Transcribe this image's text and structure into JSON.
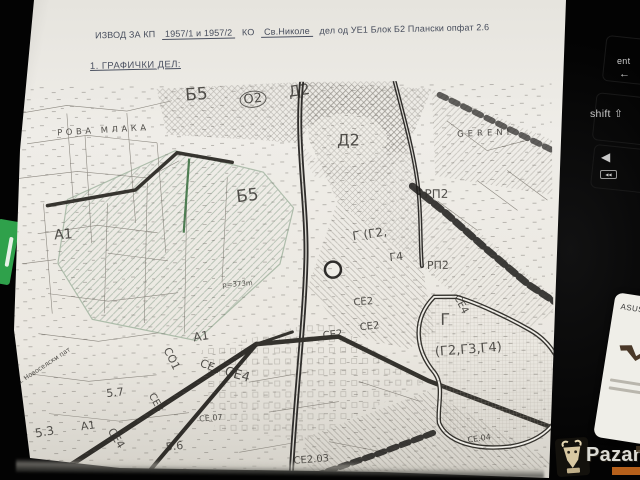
{
  "doc": {
    "header": {
      "p1": "ИЗВОД ЗА КП",
      "p2": "1957/1 и 1957/2",
      "p3": "КО",
      "p4": "Св.Николе",
      "p5": "дел од УЕ1 Блок Б2 Плански опфат 2.6"
    },
    "section_title": "1. ГРАФИЧКИ ДЕЛ:"
  },
  "map": {
    "ink_color": "#33312d",
    "green_zone_color": "#74907a",
    "labels": [
      {
        "t": "Б5",
        "x": 178,
        "y": 5,
        "s": 17,
        "r": -4
      },
      {
        "t": "О2",
        "x": 232,
        "y": 10,
        "s": 13,
        "r": -6,
        "circ": true
      },
      {
        "t": "Д2",
        "x": 281,
        "y": 3,
        "s": 15,
        "r": -8
      },
      {
        "t": "РОВА МЛАКА",
        "x": 50,
        "y": 46,
        "s": 8.5,
        "r": -3,
        "sp": 3.5
      },
      {
        "t": "GERENI",
        "x": 450,
        "y": 50,
        "s": 8.5,
        "r": -2,
        "sp": 4
      },
      {
        "t": "Д2",
        "x": 330,
        "y": 51,
        "s": 16,
        "r": 0
      },
      {
        "t": "РП2",
        "x": 417,
        "y": 107,
        "s": 12,
        "r": 0
      },
      {
        "t": "Б5",
        "x": 228,
        "y": 107,
        "s": 17,
        "r": -6
      },
      {
        "t": "А1",
        "x": 46,
        "y": 145,
        "s": 14,
        "r": -4
      },
      {
        "t": "Г (Г2,",
        "x": 344,
        "y": 149,
        "s": 12,
        "r": -8
      },
      {
        "t": "Г4",
        "x": 381,
        "y": 171,
        "s": 11,
        "r": -6
      },
      {
        "t": "РП2",
        "x": 419,
        "y": 179,
        "s": 11,
        "r": 0
      },
      {
        "t": "р=373m",
        "x": 214,
        "y": 200,
        "s": 7,
        "r": -4
      },
      {
        "t": "СЕ4",
        "x": 452,
        "y": 213,
        "s": 10,
        "r": 62
      },
      {
        "t": "СЕ2",
        "x": 345,
        "y": 217,
        "s": 10,
        "r": -4
      },
      {
        "t": "Г",
        "x": 432,
        "y": 231,
        "s": 16,
        "r": 0
      },
      {
        "t": "(Г2,Г3,Г4)",
        "x": 426,
        "y": 265,
        "s": 13,
        "r": -4
      },
      {
        "t": "СЕ2",
        "x": 314,
        "y": 250,
        "s": 10,
        "r": -6
      },
      {
        "t": "СЕ2",
        "x": 351,
        "y": 242,
        "s": 10,
        "r": -6
      },
      {
        "t": "А1",
        "x": 184,
        "y": 249,
        "s": 12,
        "r": -8
      },
      {
        "t": "СО1",
        "x": 163,
        "y": 263,
        "s": 11,
        "r": 64
      },
      {
        "t": "СЕ4",
        "x": 194,
        "y": 275,
        "s": 11,
        "r": 22
      },
      {
        "t": "СЕ4",
        "x": 218,
        "y": 283,
        "s": 13,
        "r": 16
      },
      {
        "t": "СЕ3",
        "x": 146,
        "y": 309,
        "s": 10,
        "r": 62
      },
      {
        "t": "СЕ.07",
        "x": 190,
        "y": 333,
        "s": 8,
        "r": -4
      },
      {
        "t": "5.7",
        "x": 97,
        "y": 305,
        "s": 11,
        "r": -6
      },
      {
        "t": "ул. Новоселски пат",
        "x": 4,
        "y": 299,
        "s": 6.5,
        "r": -33
      },
      {
        "t": "А1",
        "x": 71,
        "y": 338,
        "s": 11,
        "r": -8
      },
      {
        "t": "5.3",
        "x": 25,
        "y": 344,
        "s": 12,
        "r": -10
      },
      {
        "t": "СЕ4",
        "x": 106,
        "y": 343,
        "s": 11,
        "r": 58
      },
      {
        "t": "5.6",
        "x": 156,
        "y": 359,
        "s": 11,
        "r": -6
      },
      {
        "t": "СЕ.04",
        "x": 458,
        "y": 356,
        "s": 8,
        "r": -8
      },
      {
        "t": "СЕ2.03",
        "x": 284,
        "y": 375,
        "s": 10,
        "r": -4
      }
    ]
  },
  "keyboard": {
    "enter_label": "ent",
    "enter_arrow": "←",
    "shift_label": "shift",
    "shift_icon": "⇧",
    "arrow_left_icon": "◀",
    "media_prev_icon": "◀◀"
  },
  "sticker": {
    "brand": "ASUS V"
  },
  "watermark": {
    "text": "Pazar5",
    "accent_color": "#c96a1e"
  }
}
